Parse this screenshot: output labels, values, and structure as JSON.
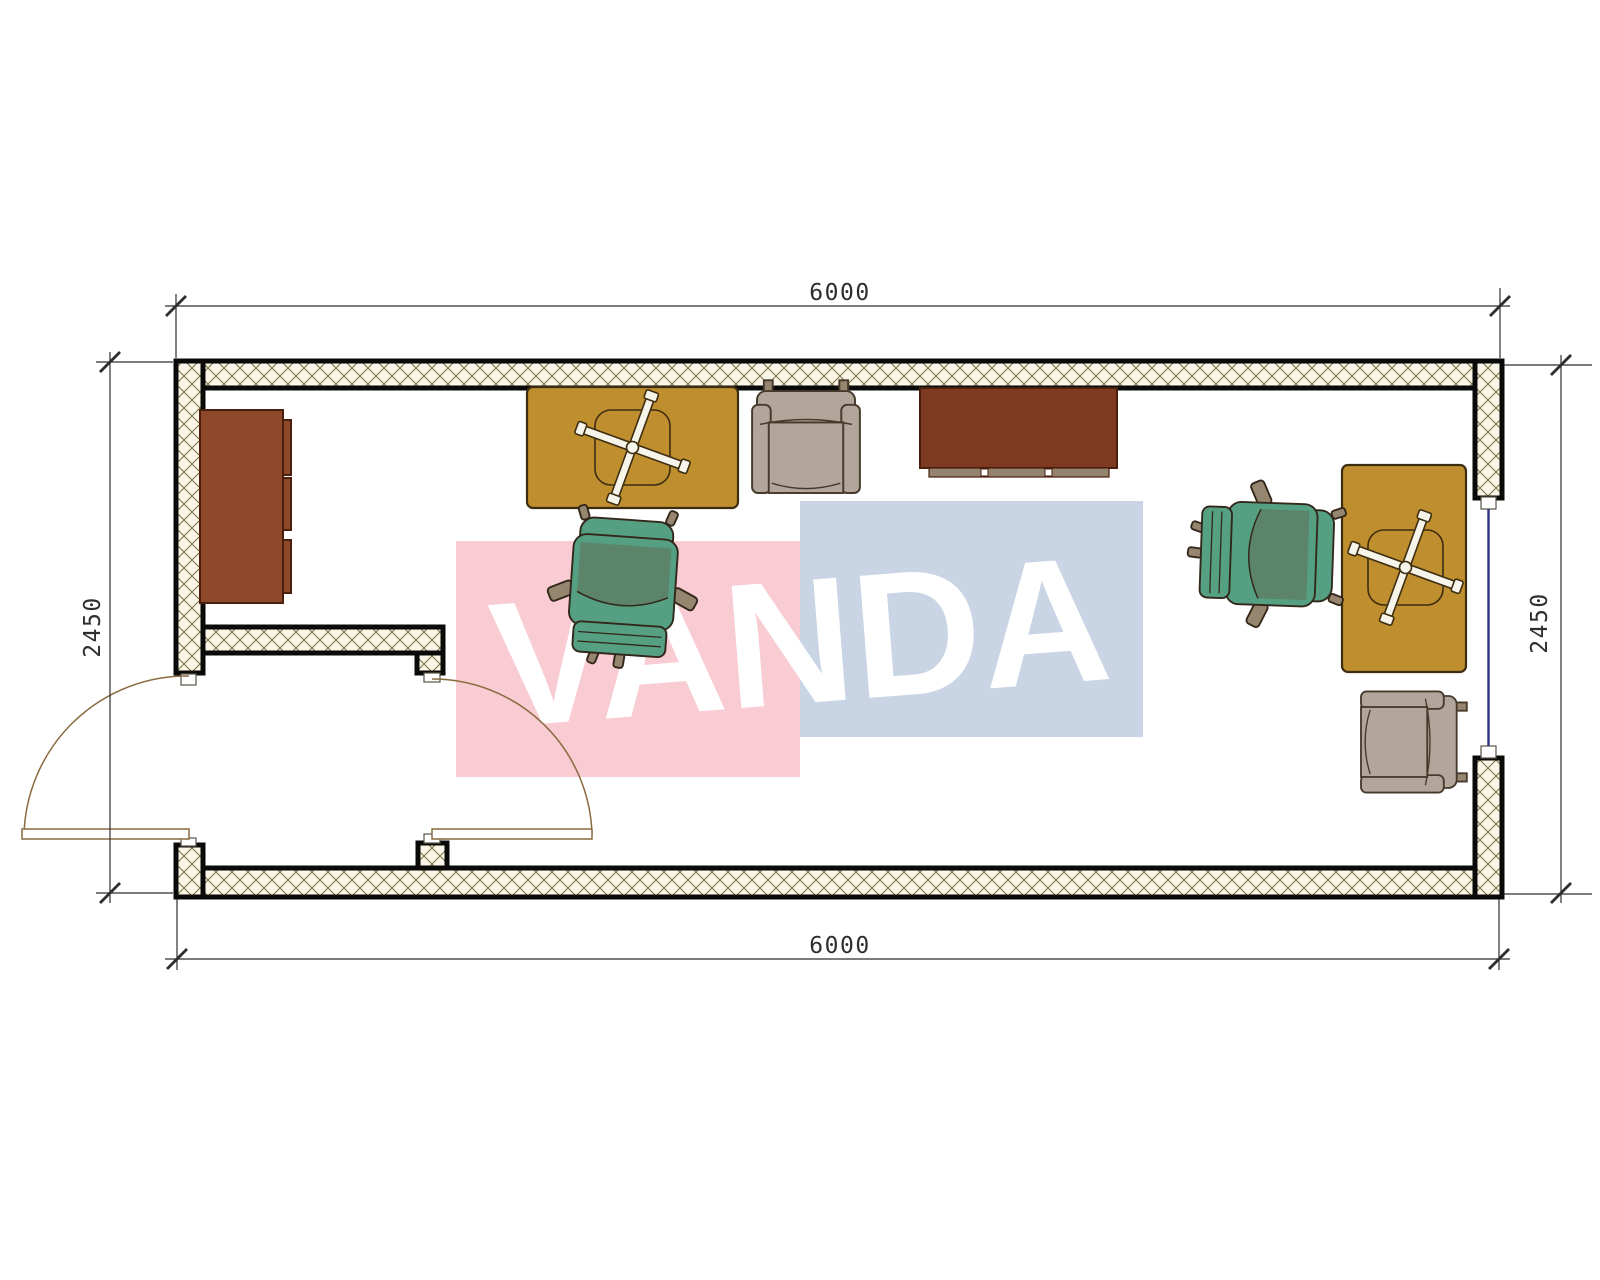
{
  "dimensions": {
    "top_mm": "6000",
    "bottom_mm": "6000",
    "left_mm": "2450",
    "right_mm": "2450"
  },
  "watermark": {
    "text": "VANDA",
    "panel_pink": "#f8ccd2",
    "panel_blue": "#c9d5e5",
    "text_color": "#ffffff"
  },
  "colors": {
    "paper": "#ffffff",
    "wall_edge": "#0a0a08",
    "hatch_bg": "#f8f4e6",
    "hatch_line": "#82754c",
    "jamb_fill": "#ffffff",
    "jamb_edge": "#5a5346",
    "window_glass": "#2a3480",
    "door": "#8a6a3f",
    "dim": "#2e2e2e",
    "desk": "#bf8e2e",
    "desk_edge": "#3c2d10",
    "chair_base_fill": "#f7f4ea",
    "cabinet": "#8e492b",
    "cabinet_edge": "#4a1f0d",
    "sideboard": "#7d3a20",
    "sideboard_base": "#93836f",
    "chair_green": "#55a083",
    "chair_green_dark": "#5c8168",
    "chair_trim": "#96866f",
    "chair_edge": "#32271a",
    "armchair": "#b1a699",
    "armchair_edge": "#463a2c"
  }
}
